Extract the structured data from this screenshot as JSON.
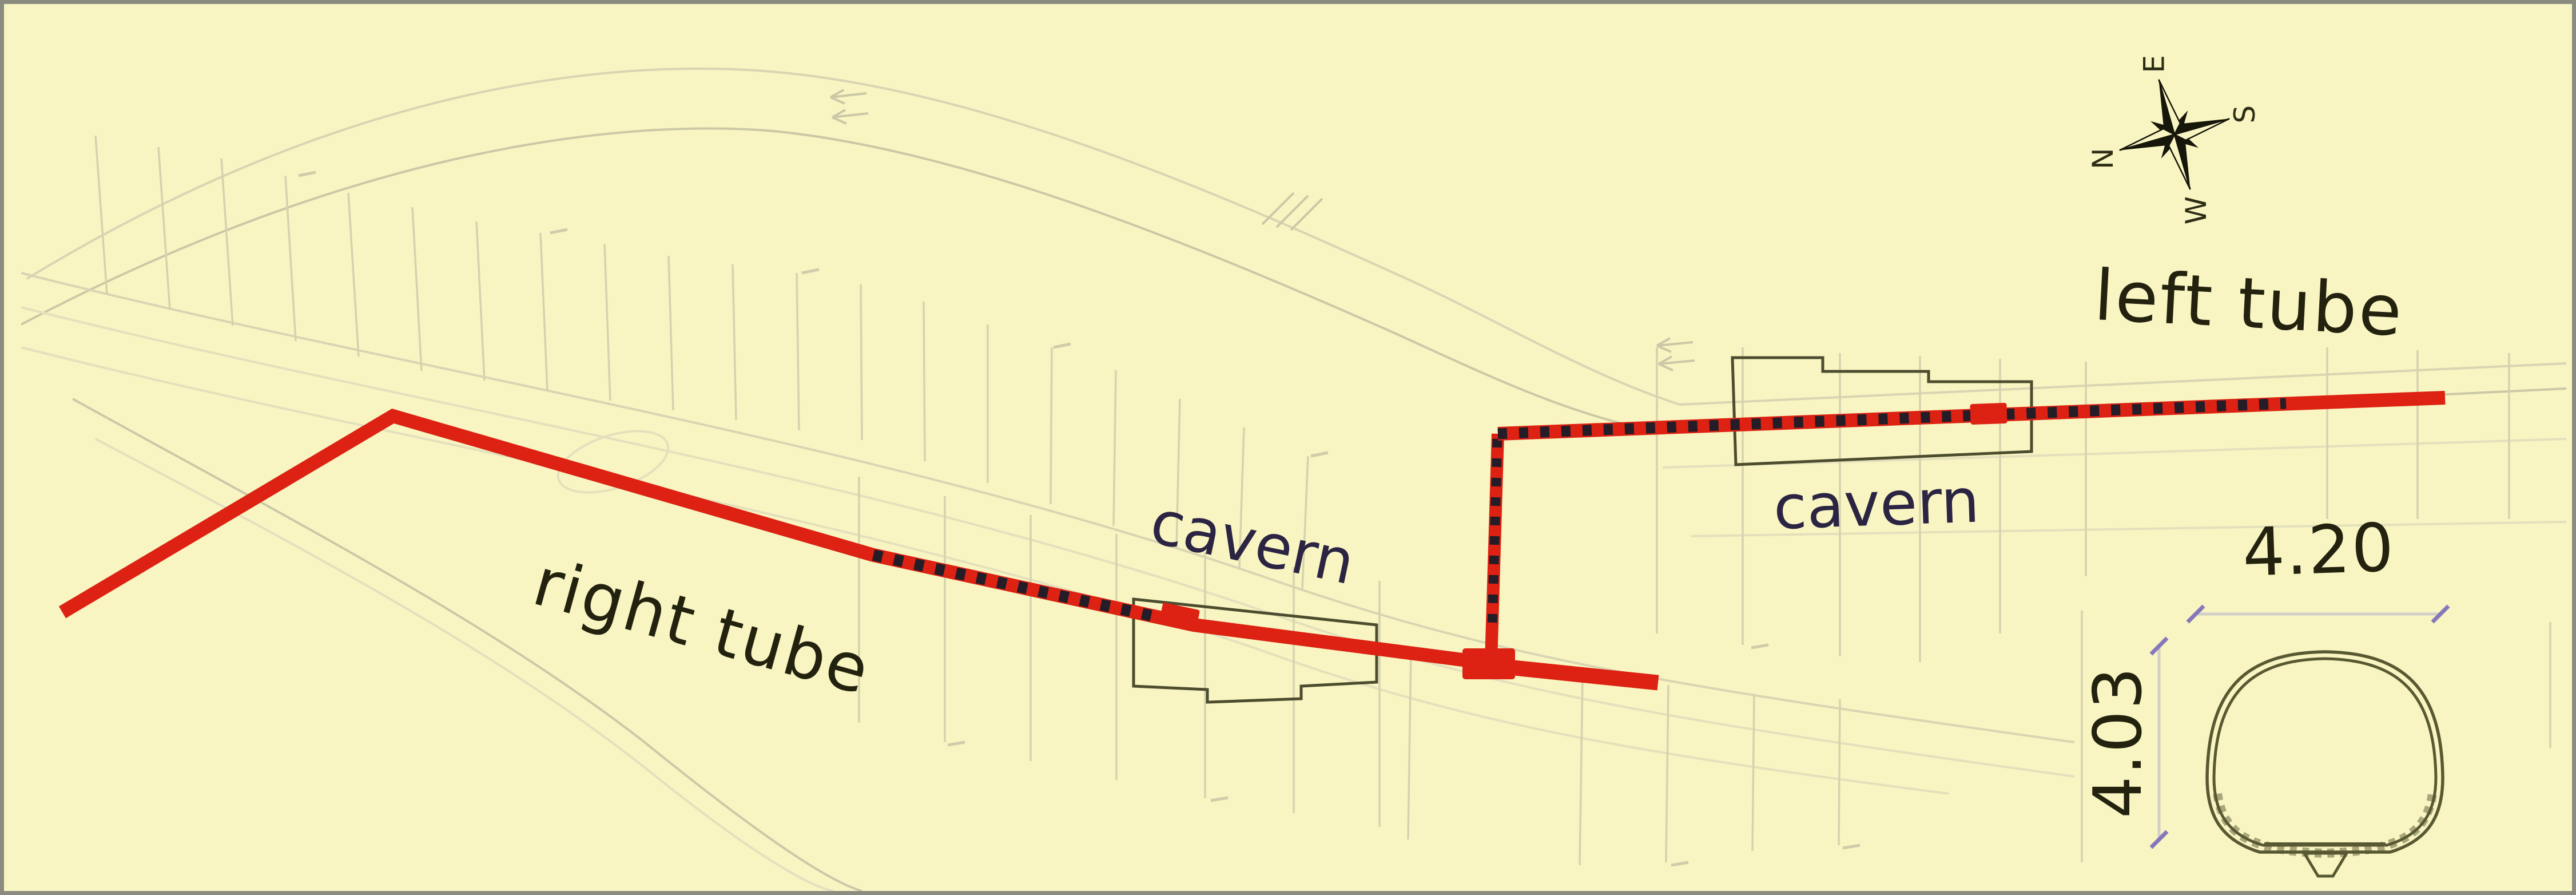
{
  "figure": {
    "type": "tunnel-plan-diagram",
    "labels": {
      "right_tube": "right tube",
      "left_tube": "left tube",
      "cavern_left": "cavern",
      "cavern_right": "cavern"
    },
    "compass": {
      "north": "N",
      "east": "E",
      "south": "S",
      "west": "W"
    },
    "cross_section": {
      "width": "4.20",
      "height": "4.03"
    },
    "colors": {
      "background": "#f8f5c2",
      "tunnel_red": "#dd2112",
      "dash_black": "#241d28",
      "cavern_text": "#2b2442",
      "label_text": "#23220f",
      "outline": "#4c4c2e",
      "dim_purple": "#8478bb",
      "faint_line": "#d8d5b2",
      "border_gray": "#8b8b80"
    }
  }
}
